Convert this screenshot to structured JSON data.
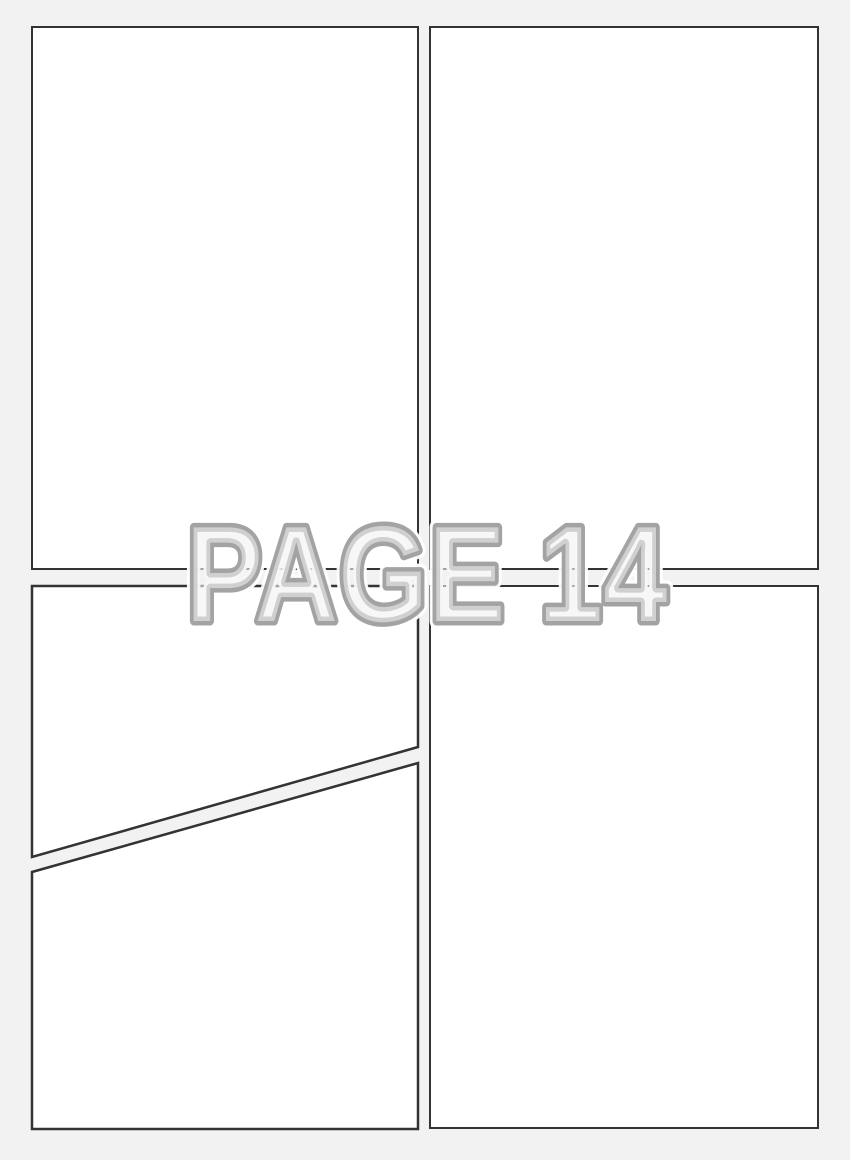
{
  "watermark": {
    "text": "PAGE 14"
  },
  "colors": {
    "background": "#f2f2f2",
    "panel_fill": "#ffffff",
    "panel_border": "#333333",
    "watermark_fill": "#f2f2f2",
    "watermark_stroke": "#9b9b9b",
    "watermark_halo": "#ffffff"
  },
  "panels": [
    {
      "name": "top-left"
    },
    {
      "name": "top-right"
    },
    {
      "name": "bottom-left-upper"
    },
    {
      "name": "bottom-left-lower"
    },
    {
      "name": "bottom-right"
    }
  ]
}
